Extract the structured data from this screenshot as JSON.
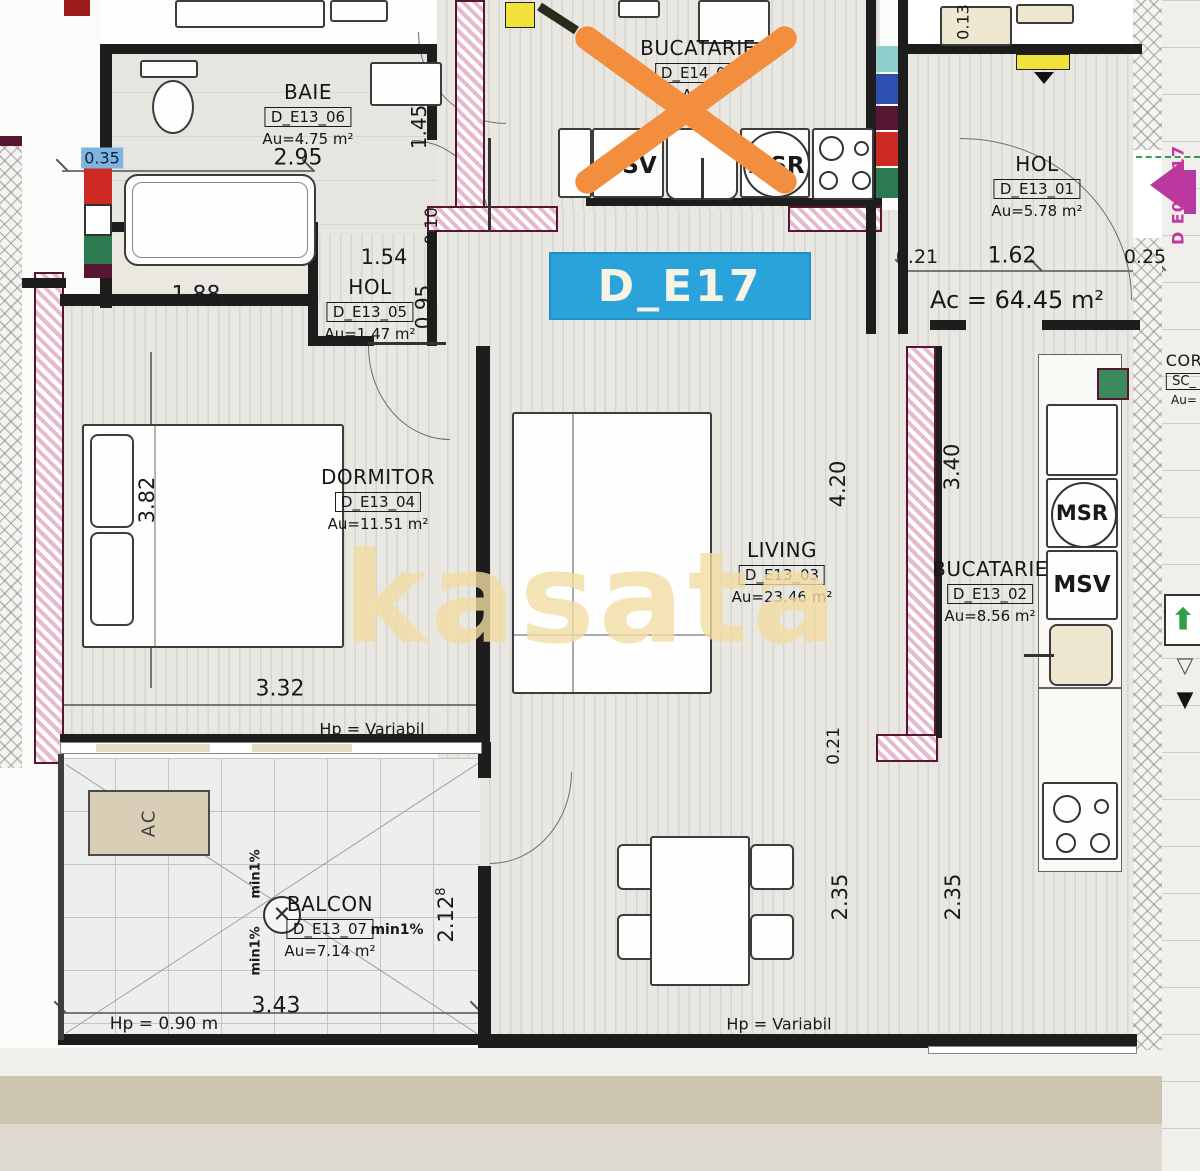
{
  "plan": {
    "unit": "D_E17",
    "total_area": "Ac = 64.45 m²",
    "watermark": "kasata",
    "side_door": "D E09/E17"
  },
  "rooms": {
    "baie": {
      "name": "BAIE",
      "code": "D_E13_06",
      "area": "Au=4.75 m²"
    },
    "bucatarie_top": {
      "name": "BUCATARIE",
      "code": "D_E14_02",
      "area": "Au="
    },
    "hol_right": {
      "name": "HOL",
      "code": "D_E13_01",
      "area": "Au=5.78 m²"
    },
    "hol_mid": {
      "name": "HOL",
      "code": "D_E13_05",
      "area": "Au=1.47 m²"
    },
    "dormitor": {
      "name": "DORMITOR",
      "code": "D_E13_04",
      "area": "Au=11.51 m²"
    },
    "living": {
      "name": "LIVING",
      "code": "D_E13_03",
      "area": "Au=23.46 m²"
    },
    "bucatarie_right": {
      "name": "BUCATARIE",
      "code": "D_E13_02",
      "area": "Au=8.56 m²"
    },
    "balcon": {
      "name": "BALCON",
      "code": "D_E13_07",
      "area": "Au=7.14 m²"
    },
    "coridor": {
      "name": "COR",
      "code": "SC_",
      "area": "Au="
    }
  },
  "dims": {
    "baie_w": "2.95",
    "baie_door": "1.45",
    "left_top": "0.35",
    "dorm_top": "1.88",
    "holmid_w": "1.54",
    "holmid_h": "0.95",
    "holmid_wall": "0.10",
    "dorm_h": "3.82",
    "dorm_w": "3.32",
    "hol_a": "0.21",
    "hol_b": "1.62",
    "hol_c": "0.25",
    "top_right": "0.13",
    "living_h": "4.20",
    "kitchen_h": "3.40",
    "living_wall": "0.21",
    "living_b": "2.35",
    "kitchen_b": "2.35",
    "balcon_h": "2.12",
    "balcon_h_sup": "8",
    "balcon_w": "3.43"
  },
  "annotations": {
    "hp_dorm": "Hp = Variabil",
    "hp_living": "Hp = Variabil",
    "hp_balcon": "Hp = 0.90 m",
    "min1_a": "min1%",
    "min1_b": "min1%",
    "min1_c": "min1%",
    "ac_unit": "AC"
  },
  "appliances": {
    "msv_top": "MSV",
    "msr_top": "MSR",
    "msr_right": "MSR",
    "msv_right": "MSV"
  },
  "icons": {
    "drain_cross": "✕",
    "stairs_up": "⬆",
    "tri_down_outline": "▽",
    "tri_down_filled": "▼"
  },
  "colors": {
    "banner_bg": "#2aa2da",
    "cross_orange": "#f28e3d",
    "watermark": "#f2dda2",
    "door_magenta": "#b8399d"
  }
}
